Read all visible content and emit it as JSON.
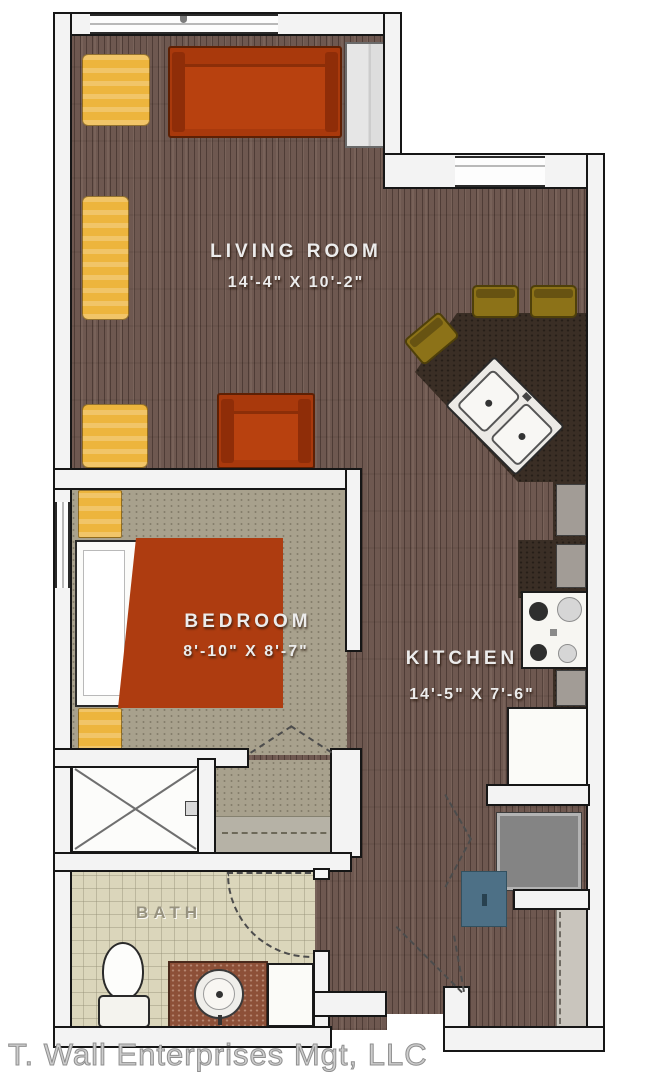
{
  "plan_title": "One-bedroom apartment floor plan",
  "rooms": {
    "living": {
      "name": "LIVING ROOM",
      "dims": "14'-4\" X 10'-2\""
    },
    "bedroom": {
      "name": "BEDROOM",
      "dims": "8'-10\" X 8'-7\""
    },
    "kitchen": {
      "name": "KITCHEN",
      "dims": "14'-5\" X 7'-6\""
    },
    "bath": {
      "name": "BATH"
    }
  },
  "watermark": {
    "text": "T. Wall Enterprises Mgt, LLC"
  },
  "colors": {
    "wood_floor": "#6e5850",
    "carpet": "#a8a18d",
    "bath_tile": "#dbd6bb",
    "kitchen_counter": "#3a2e25",
    "sofa_rust": "#a9390c",
    "accent_yellow": "#edb53d",
    "stool_olive": "#8c7218",
    "utility_teal": "#4d7086",
    "appliance_gray": "#848484",
    "wall_fill": "#f3f3f3",
    "wall_line": "#161616"
  },
  "fixtures": [
    "sofa",
    "armchair",
    "accent-chair",
    "storage-bench",
    "bar-stools",
    "double-basin-sink",
    "range-stove",
    "refrigerator",
    "washer-dryer",
    "bed",
    "nightstands",
    "shower",
    "toilet",
    "vanity-sink",
    "linen-cabinet",
    "entry-door",
    "closets",
    "windows"
  ]
}
